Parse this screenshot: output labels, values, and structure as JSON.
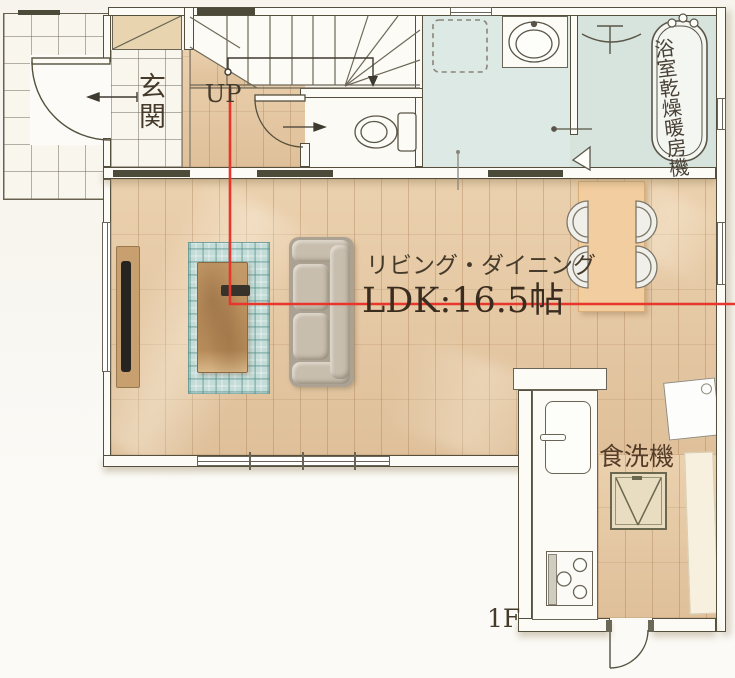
{
  "floor_plan": {
    "floor_label": "1F",
    "labels": {
      "entrance": "玄関",
      "stairs_direction": "UP",
      "living_dining_name": "リビング・ダイニング",
      "living_dining_size": "LDK:16.5帖",
      "bathroom_unit": "浴室乾燥暖房機",
      "dishwasher": "食洗機"
    },
    "colors": {
      "wood_floor": "#e6c9a4",
      "plank_line": "#b99470",
      "wet_area_floor": "#dde9e4",
      "bath_floor": "#d6e4dd",
      "wall_fill": "#fcfbf6",
      "wall_line": "#55503e",
      "threshold_dark": "#4c4a38",
      "section_line_red": "#e8362c",
      "rug_teal": "#a8cfc9",
      "sofa_gray": "#b4aa9b",
      "coffee_table_wood": "#bb905f",
      "dining_table_wood": "#f2cd9f",
      "tv_board_wood": "#c89f6f",
      "label_text": "#463b2b",
      "background": "#f7f5ee"
    }
  }
}
